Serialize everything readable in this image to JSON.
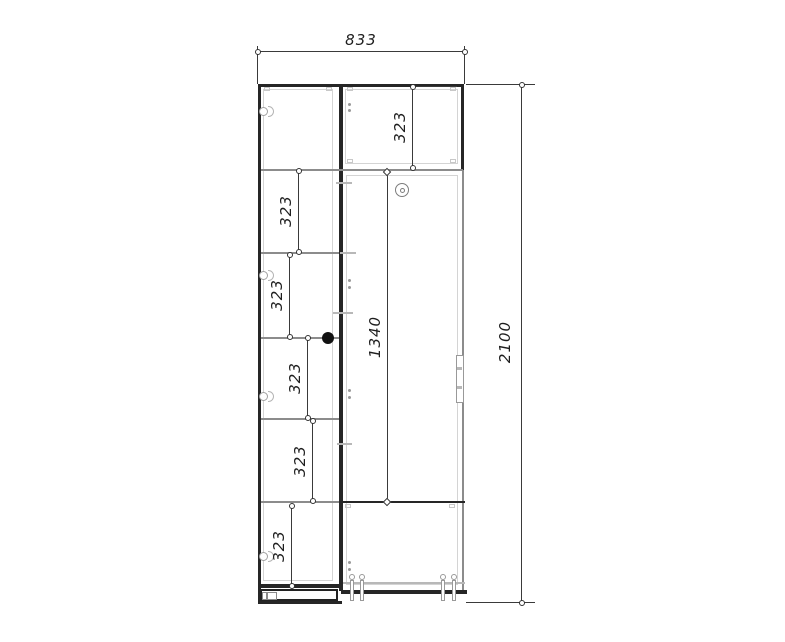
{
  "drawing": {
    "labels": {
      "overall_width": "833",
      "overall_height": "2100",
      "inner_height": "1340",
      "section_height": "323"
    },
    "colors": {
      "background": "#ffffff",
      "line_dark": "#262626",
      "line_gray": "#8c8c8c",
      "dimension_line": "#3a3a3a",
      "dimension_text": "#1e1e1e"
    }
  }
}
